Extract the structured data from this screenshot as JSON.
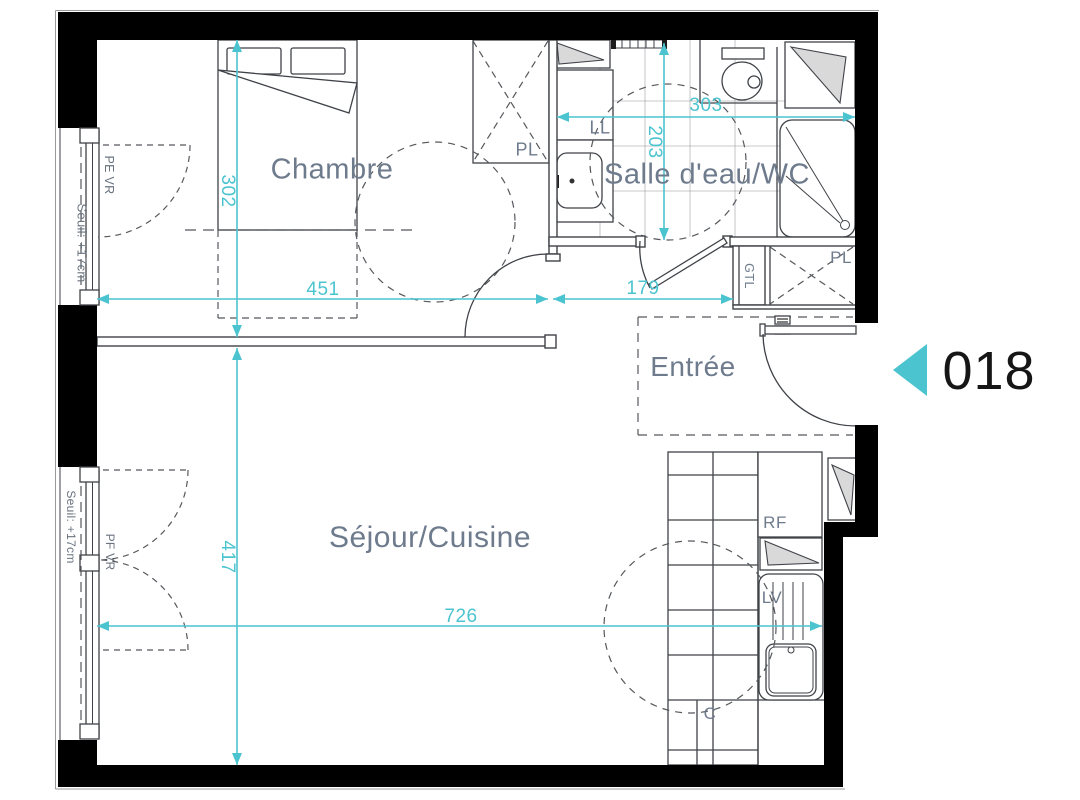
{
  "floorplan": {
    "unit": {
      "number": "018"
    },
    "rooms": [
      {
        "id": "bedroom",
        "label": "Chambre"
      },
      {
        "id": "bathroom",
        "label": "Salle d'eau/WC"
      },
      {
        "id": "entry",
        "label": "Entrée"
      },
      {
        "id": "living_kitchen",
        "label": "Séjour/Cuisine"
      }
    ],
    "dimensions_cm": {
      "bedroom_depth": "302",
      "bedroom_width": "451",
      "entry_width": "179",
      "bathroom_depth": "203",
      "bathroom_width": "303",
      "living_depth": "417",
      "living_width": "726"
    },
    "equipment_labels": {
      "closet_bedroom": "PL",
      "closet_entry": "PL",
      "washing_machine": "LL",
      "technical_duct": "GTL",
      "fridge": "RF",
      "dishwasher": "LV",
      "cooktop": "C"
    },
    "window_labels": {
      "threshold_top": "Seuil: +17cm",
      "threshold_bottom": "Seuil: +17cm",
      "window_top": "PE VR",
      "window_bottom": "PF VR"
    },
    "colors": {
      "wall": "#000000",
      "line": "#3f4247",
      "dimension": "#4cc4d0",
      "room_label": "#6e7b8d",
      "unit_marker": "#4cc4d0",
      "unit_number": "#161616"
    }
  }
}
